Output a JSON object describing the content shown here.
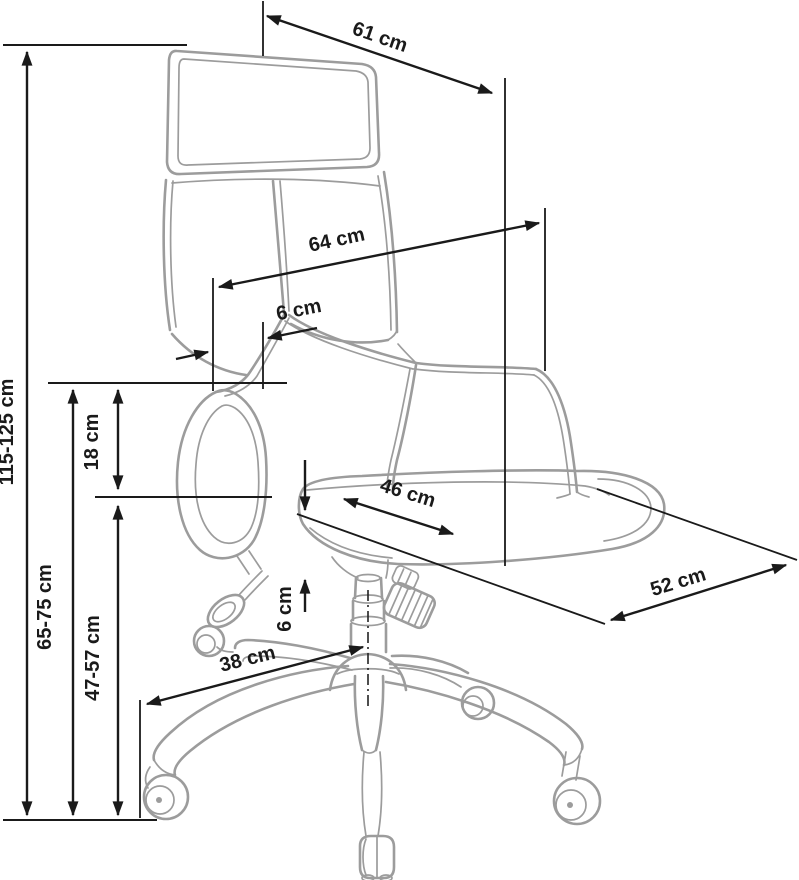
{
  "diagram": {
    "subject": "Office swivel chair technical dimension drawing, three-quarter side view",
    "unit": "cm",
    "colors": {
      "background": "#ffffff",
      "dimension_lines": "#1a1a1a",
      "chair_outline": "#9c9c9c"
    },
    "dimensions": {
      "overall_height": {
        "label": "115-125 cm",
        "min": 115,
        "max": 125,
        "orientation": "vertical"
      },
      "headrest_width": {
        "label": "61 cm",
        "value": 61,
        "orientation": "diagonal"
      },
      "backrest_width": {
        "label": "64 cm",
        "value": 64,
        "orientation": "diagonal"
      },
      "backrest_offset": {
        "label": "6 cm",
        "value": 6,
        "orientation": "diagonal"
      },
      "backrest_to_armrest": {
        "label": "18 cm",
        "value": 18,
        "orientation": "vertical"
      },
      "seat_width": {
        "label": "46 cm",
        "value": 46,
        "orientation": "diagonal"
      },
      "seat_depth": {
        "label": "52 cm",
        "value": 52,
        "orientation": "diagonal"
      },
      "armrest_height": {
        "label": "65-75 cm",
        "min": 65,
        "max": 75,
        "orientation": "vertical"
      },
      "seat_height": {
        "label": "47-57 cm",
        "min": 47,
        "max": 57,
        "orientation": "vertical"
      },
      "seat_edge_offset": {
        "label": "6 cm",
        "value": 6,
        "orientation": "vertical"
      },
      "base_leg_reach": {
        "label": "38 cm",
        "value": 38,
        "orientation": "diagonal"
      }
    }
  }
}
